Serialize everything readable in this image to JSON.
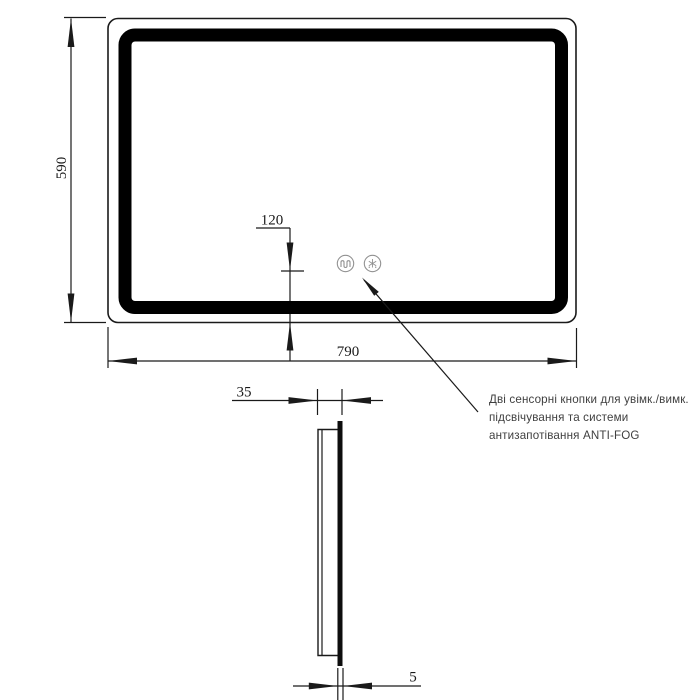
{
  "page": {
    "background": "#ffffff"
  },
  "drawing": {
    "colors": {
      "line": "#1a1a1a",
      "led_band": "#000000",
      "button_stroke": "#919191",
      "dim_text": "#1a1a1a",
      "annotation_text": "#3f3f3f"
    },
    "front_view": {
      "height_dim": "590",
      "width_dim": "790",
      "button_offset_dim": "120",
      "buttons": [
        {
          "icon": "demister-coil-icon"
        },
        {
          "icon": "anti-fog-snowflake-icon"
        }
      ]
    },
    "side_view": {
      "depth_dim": "35",
      "glass_thickness_dim": "5"
    },
    "annotation": {
      "lines": [
        "Дві сенсорні кнопки для увімк./вимк.",
        "підсвічування та системи",
        "антизапотівання ANTI-FOG"
      ]
    }
  }
}
